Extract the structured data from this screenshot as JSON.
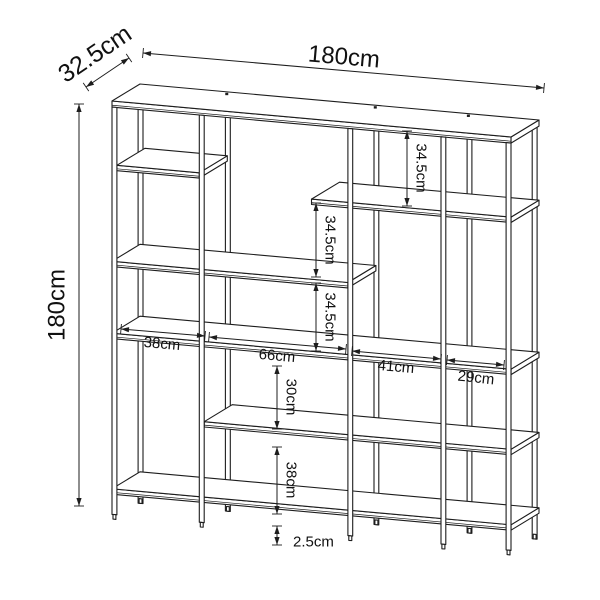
{
  "canvas": {
    "width": 600,
    "height": 600,
    "background": "#ffffff",
    "line_color": "#1d1d1d",
    "text_color": "#111111"
  },
  "diagram": {
    "type": "furniture-dimension-drawing",
    "subject": "open metal-frame shelving unit, isometric technical line drawing with dimension arrows",
    "unit": "cm",
    "overall": {
      "width_label": "180cm",
      "height_label": "180cm",
      "depth_label": "32.5cm"
    },
    "annotations": [
      {
        "id": "depth-overall",
        "label": "32.5cm",
        "value": 32.5,
        "measures": "overall depth",
        "x1": 86,
        "y1": 87,
        "x2": 129,
        "y2": 58,
        "tx": 95,
        "ty": 54,
        "rot": -34,
        "fs": 25,
        "anchor": "middle"
      },
      {
        "id": "width-overall",
        "label": "180cm",
        "value": 180,
        "measures": "overall width",
        "x1": 143,
        "y1": 53,
        "x2": 544,
        "y2": 88,
        "tx": 344,
        "ty": 57,
        "rot": 5,
        "fs": 24,
        "anchor": "middle"
      },
      {
        "id": "height-overall",
        "label": "180cm",
        "value": 180,
        "measures": "overall height",
        "x1": 79,
        "y1": 104,
        "x2": 79,
        "y2": 506,
        "tx": 57,
        "ty": 305,
        "rot": -90,
        "fs": 24,
        "anchor": "middle"
      },
      {
        "id": "height-34-5-top",
        "label": "34.5cm",
        "value": 34.5,
        "measures": "top to upper-right shelf",
        "x1": 407,
        "y1": 131,
        "x2": 407,
        "y2": 206,
        "tx": 421,
        "ty": 168,
        "rot": 90,
        "fs": 15,
        "anchor": "middle"
      },
      {
        "id": "height-34-5-mid",
        "label": "34.5cm",
        "value": 34.5,
        "measures": "upper shelf spacing",
        "x1": 316,
        "y1": 203,
        "x2": 316,
        "y2": 277,
        "tx": 330,
        "ty": 240,
        "rot": 90,
        "fs": 15,
        "anchor": "middle"
      },
      {
        "id": "height-34-5-low",
        "label": "34.5cm",
        "value": 34.5,
        "measures": "middle shelf spacing",
        "x1": 316,
        "y1": 283,
        "x2": 316,
        "y2": 351,
        "tx": 330,
        "ty": 317,
        "rot": 90,
        "fs": 15,
        "anchor": "middle"
      },
      {
        "id": "width-38",
        "label": "38cm",
        "value": 38,
        "measures": "bay 1 width",
        "x1": 121,
        "y1": 329,
        "x2": 205,
        "y2": 336,
        "tx": 162,
        "ty": 344,
        "rot": 5,
        "fs": 15,
        "anchor": "middle"
      },
      {
        "id": "width-66",
        "label": "66cm",
        "value": 66,
        "measures": "bay 2 width",
        "x1": 209,
        "y1": 337,
        "x2": 346,
        "y2": 349,
        "tx": 277,
        "ty": 356,
        "rot": 5,
        "fs": 15,
        "anchor": "middle"
      },
      {
        "id": "width-41",
        "label": "41cm",
        "value": 41,
        "measures": "bay 3 width",
        "x1": 352,
        "y1": 351,
        "x2": 441,
        "y2": 359,
        "tx": 396,
        "ty": 367,
        "rot": 5,
        "fs": 15,
        "anchor": "middle"
      },
      {
        "id": "width-29",
        "label": "29cm",
        "value": 29,
        "measures": "bay 4 width",
        "x1": 447,
        "y1": 360,
        "x2": 504,
        "y2": 365,
        "tx": 476,
        "ty": 378,
        "rot": 6,
        "fs": 15,
        "anchor": "middle"
      },
      {
        "id": "height-30",
        "label": "30cm",
        "value": 30,
        "measures": "mid to lower shelf",
        "x1": 277,
        "y1": 366,
        "x2": 277,
        "y2": 429,
        "tx": 291,
        "ty": 397,
        "rot": 90,
        "fs": 15,
        "anchor": "middle"
      },
      {
        "id": "height-38",
        "label": "38cm",
        "value": 38,
        "measures": "lower to bottom shelf",
        "x1": 277,
        "y1": 447,
        "x2": 277,
        "y2": 514,
        "tx": 291,
        "ty": 480,
        "rot": 90,
        "fs": 15,
        "anchor": "middle"
      },
      {
        "id": "height-2-5",
        "label": "2.5cm",
        "value": 2.5,
        "measures": "bottom shelf ground clearance",
        "x1": 277,
        "y1": 526,
        "x2": 277,
        "y2": 545,
        "tx": 293,
        "ty": 542,
        "rot": 0,
        "fs": 15,
        "anchor": "start"
      }
    ],
    "model": {
      "projection": {
        "ox": 112,
        "oy": 519,
        "ux": 2.2167,
        "uy": 0.2,
        "vx": 0,
        "vy": -2.322,
        "wx": 0.8615,
        "wy": -0.523
      },
      "depth": 32.5,
      "back_w": 30.3,
      "post_half": 1.1,
      "post_top_v": 177.4,
      "posts_u": [
        1.1,
        40.5,
        107.5,
        149.5,
        178.9
      ],
      "shelves": [
        {
          "u1": 0,
          "u2": 180,
          "vt": 180,
          "vb": 177.4
        },
        {
          "u1": 2.2,
          "u2": 39.4,
          "vt": 152.5,
          "vb": 150.2
        },
        {
          "u1": 90,
          "u2": 180,
          "vt": 145.5,
          "vb": 143.2
        },
        {
          "u1": 0,
          "u2": 106.4,
          "vt": 111,
          "vb": 108.7
        },
        {
          "u1": 0,
          "u2": 180,
          "vt": 80,
          "vb": 77.7
        },
        {
          "u1": 41.6,
          "u2": 180,
          "vt": 45.5,
          "vb": 43.2
        },
        {
          "u1": 0,
          "u2": 180,
          "vt": 13,
          "vb": 10.7
        }
      ]
    }
  }
}
